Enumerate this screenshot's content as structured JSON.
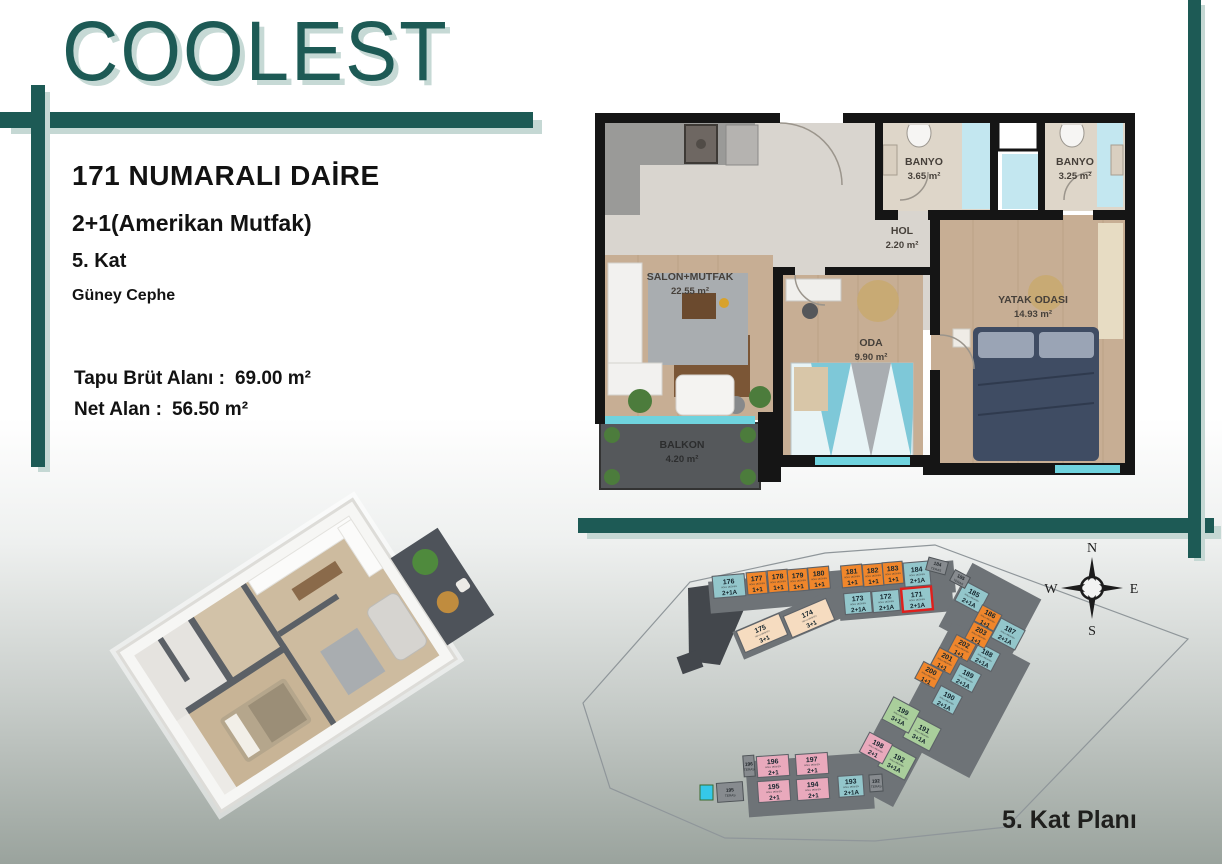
{
  "brand": {
    "name": "COOLEST"
  },
  "info": {
    "title": "171 NUMARALI DAİRE",
    "type": "2+1(Amerikan Mutfak)",
    "floor": "5. Kat",
    "facade": "Güney Cephe",
    "gross_label": "Tapu Brüt Alanı :",
    "gross_value": "69.00 m²",
    "net_label": "Net Alan :",
    "net_value": "56.50 m²"
  },
  "floorplan": {
    "rooms": [
      {
        "name": "SALON+MUTFAK",
        "area": "22.55 m²"
      },
      {
        "name": "BANYO",
        "area": "3.65 m²"
      },
      {
        "name": "BANYO",
        "area": "3.25 m²"
      },
      {
        "name": "HOL",
        "area": "2.20 m²"
      },
      {
        "name": "ODA",
        "area": "9.90 m²"
      },
      {
        "name": "YATAK ODASI",
        "area": "14.93 m²"
      },
      {
        "name": "BALKON",
        "area": "4.20 m²"
      }
    ]
  },
  "siteplan": {
    "title": "5. Kat Planı",
    "unit_sublabel": "NOLU MESKEN",
    "teras_label": "TERAS",
    "compass": {
      "n": "N",
      "e": "E",
      "s": "S",
      "w": "W"
    },
    "units": [
      {
        "no": "171",
        "type": "2+1A",
        "cat": "t",
        "x": 342,
        "y": 64,
        "w": 30,
        "h": 23,
        "r": -5,
        "hl": true
      },
      {
        "no": "172",
        "type": "2+1A",
        "cat": "t",
        "x": 311,
        "y": 66,
        "w": 27,
        "h": 21,
        "r": -5
      },
      {
        "no": "173",
        "type": "2+1A",
        "cat": "t",
        "x": 283,
        "y": 68,
        "w": 27,
        "h": 21,
        "r": -5
      },
      {
        "no": "174",
        "type": "3+1",
        "cat": "c",
        "x": 234,
        "y": 83,
        "w": 46,
        "h": 23,
        "r": -23
      },
      {
        "no": "175",
        "type": "3+1",
        "cat": "c",
        "x": 187,
        "y": 98,
        "w": 46,
        "h": 23,
        "r": -23
      },
      {
        "no": "176",
        "type": "2+1A",
        "cat": "t",
        "x": 154,
        "y": 51,
        "w": 32,
        "h": 22,
        "r": -5
      },
      {
        "no": "177",
        "type": "1+1",
        "cat": "o",
        "x": 182,
        "y": 48,
        "w": 20,
        "h": 22,
        "r": -5
      },
      {
        "no": "178",
        "type": "1+1",
        "cat": "o",
        "x": 203,
        "y": 46,
        "w": 20,
        "h": 22,
        "r": -5
      },
      {
        "no": "179",
        "type": "1+1",
        "cat": "o",
        "x": 223,
        "y": 45,
        "w": 20,
        "h": 22,
        "r": -5
      },
      {
        "no": "180",
        "type": "1+1",
        "cat": "o",
        "x": 244,
        "y": 43,
        "w": 21,
        "h": 22,
        "r": -5
      },
      {
        "no": "181",
        "type": "1+1",
        "cat": "o",
        "x": 277,
        "y": 41,
        "w": 21,
        "h": 22,
        "r": -5
      },
      {
        "no": "182",
        "type": "1+1",
        "cat": "o",
        "x": 298,
        "y": 40,
        "w": 20,
        "h": 22,
        "r": -5
      },
      {
        "no": "183",
        "type": "1+1",
        "cat": "o",
        "x": 318,
        "y": 38,
        "w": 20,
        "h": 22,
        "r": -5
      },
      {
        "no": "184",
        "type": "2+1A",
        "cat": "t",
        "x": 342,
        "y": 39,
        "w": 26,
        "h": 24,
        "r": -5
      },
      {
        "no": "185",
        "type": "2+1A",
        "cat": "t",
        "x": 397,
        "y": 62,
        "w": 27,
        "h": 22,
        "r": 28
      },
      {
        "no": "186",
        "type": "1+1",
        "cat": "o",
        "x": 413,
        "y": 83,
        "w": 22,
        "h": 18,
        "r": 28
      },
      {
        "no": "187",
        "type": "2+1A",
        "cat": "t",
        "x": 433,
        "y": 99,
        "w": 27,
        "h": 22,
        "r": 28
      },
      {
        "no": "188",
        "type": "2+1A",
        "cat": "t",
        "x": 410,
        "y": 122,
        "w": 24,
        "h": 20,
        "r": 28
      },
      {
        "no": "189",
        "type": "2+1A",
        "cat": "t",
        "x": 391,
        "y": 143,
        "w": 24,
        "h": 20,
        "r": 28
      },
      {
        "no": "190",
        "type": "2+1A",
        "cat": "t",
        "x": 372,
        "y": 165,
        "w": 24,
        "h": 20,
        "r": 28
      },
      {
        "no": "191",
        "type": "3+1A",
        "cat": "g",
        "x": 347,
        "y": 198,
        "w": 30,
        "h": 25,
        "r": 28
      },
      {
        "no": "192",
        "type": "3+1A",
        "cat": "g",
        "x": 322,
        "y": 227,
        "w": 30,
        "h": 25,
        "r": 28
      },
      {
        "no": "193",
        "type": "2+1A",
        "cat": "t",
        "x": 276,
        "y": 251,
        "w": 25,
        "h": 21,
        "r": -4
      },
      {
        "no": "194",
        "type": "2+1",
        "cat": "p",
        "x": 238,
        "y": 254,
        "w": 32,
        "h": 21,
        "r": -4
      },
      {
        "no": "195",
        "type": "2+1",
        "cat": "p",
        "x": 199,
        "y": 256,
        "w": 32,
        "h": 21,
        "r": -4
      },
      {
        "no": "196",
        "type": "2+1",
        "cat": "p",
        "x": 198,
        "y": 231,
        "w": 32,
        "h": 21,
        "r": -4
      },
      {
        "no": "197",
        "type": "2+1",
        "cat": "p",
        "x": 237,
        "y": 229,
        "w": 32,
        "h": 21,
        "r": -4
      },
      {
        "no": "198",
        "type": "2+1",
        "cat": "p",
        "x": 301,
        "y": 213,
        "w": 26,
        "h": 22,
        "r": 28
      },
      {
        "no": "199",
        "type": "3+1A",
        "cat": "g",
        "x": 326,
        "y": 180,
        "w": 30,
        "h": 25,
        "r": 28
      },
      {
        "no": "200",
        "type": "1+1",
        "cat": "o",
        "x": 354,
        "y": 140,
        "w": 22,
        "h": 19,
        "r": 28
      },
      {
        "no": "201",
        "type": "1+1",
        "cat": "o",
        "x": 370,
        "y": 126,
        "w": 22,
        "h": 19,
        "r": 28
      },
      {
        "no": "202",
        "type": "1+1",
        "cat": "o",
        "x": 387,
        "y": 113,
        "w": 22,
        "h": 19,
        "r": 28
      },
      {
        "no": "203",
        "type": "1+1",
        "cat": "o",
        "x": 404,
        "y": 100,
        "w": 22,
        "h": 19,
        "r": 28
      }
    ],
    "teras_units": [
      {
        "no": "184",
        "x": 362,
        "y": 31,
        "w": 20,
        "h": 13,
        "r": 15
      },
      {
        "no": "185",
        "x": 385,
        "y": 44,
        "w": 17,
        "h": 12,
        "r": 28
      },
      {
        "no": "192",
        "x": 301,
        "y": 248,
        "w": 13,
        "h": 17,
        "r": -4
      },
      {
        "no": "196",
        "x": 174,
        "y": 231,
        "w": 11,
        "h": 21,
        "r": -4
      },
      {
        "no": "195",
        "x": 155,
        "y": 257,
        "w": 26,
        "h": 19,
        "r": -4
      }
    ]
  },
  "colors": {
    "brand_teal": "#1d5a55",
    "teal_shadow": "#c5d8d4",
    "unit_2_1A": "#93c6cb",
    "unit_1_1": "#f0862b",
    "unit_3_1": "#f6dcc0",
    "unit_3_1A": "#a9ce9b",
    "unit_2_1": "#e9a9bc",
    "teras_gray": "#878b8f",
    "highlight_red": "#e01f1c",
    "window_cyan": "#6fd3de"
  }
}
